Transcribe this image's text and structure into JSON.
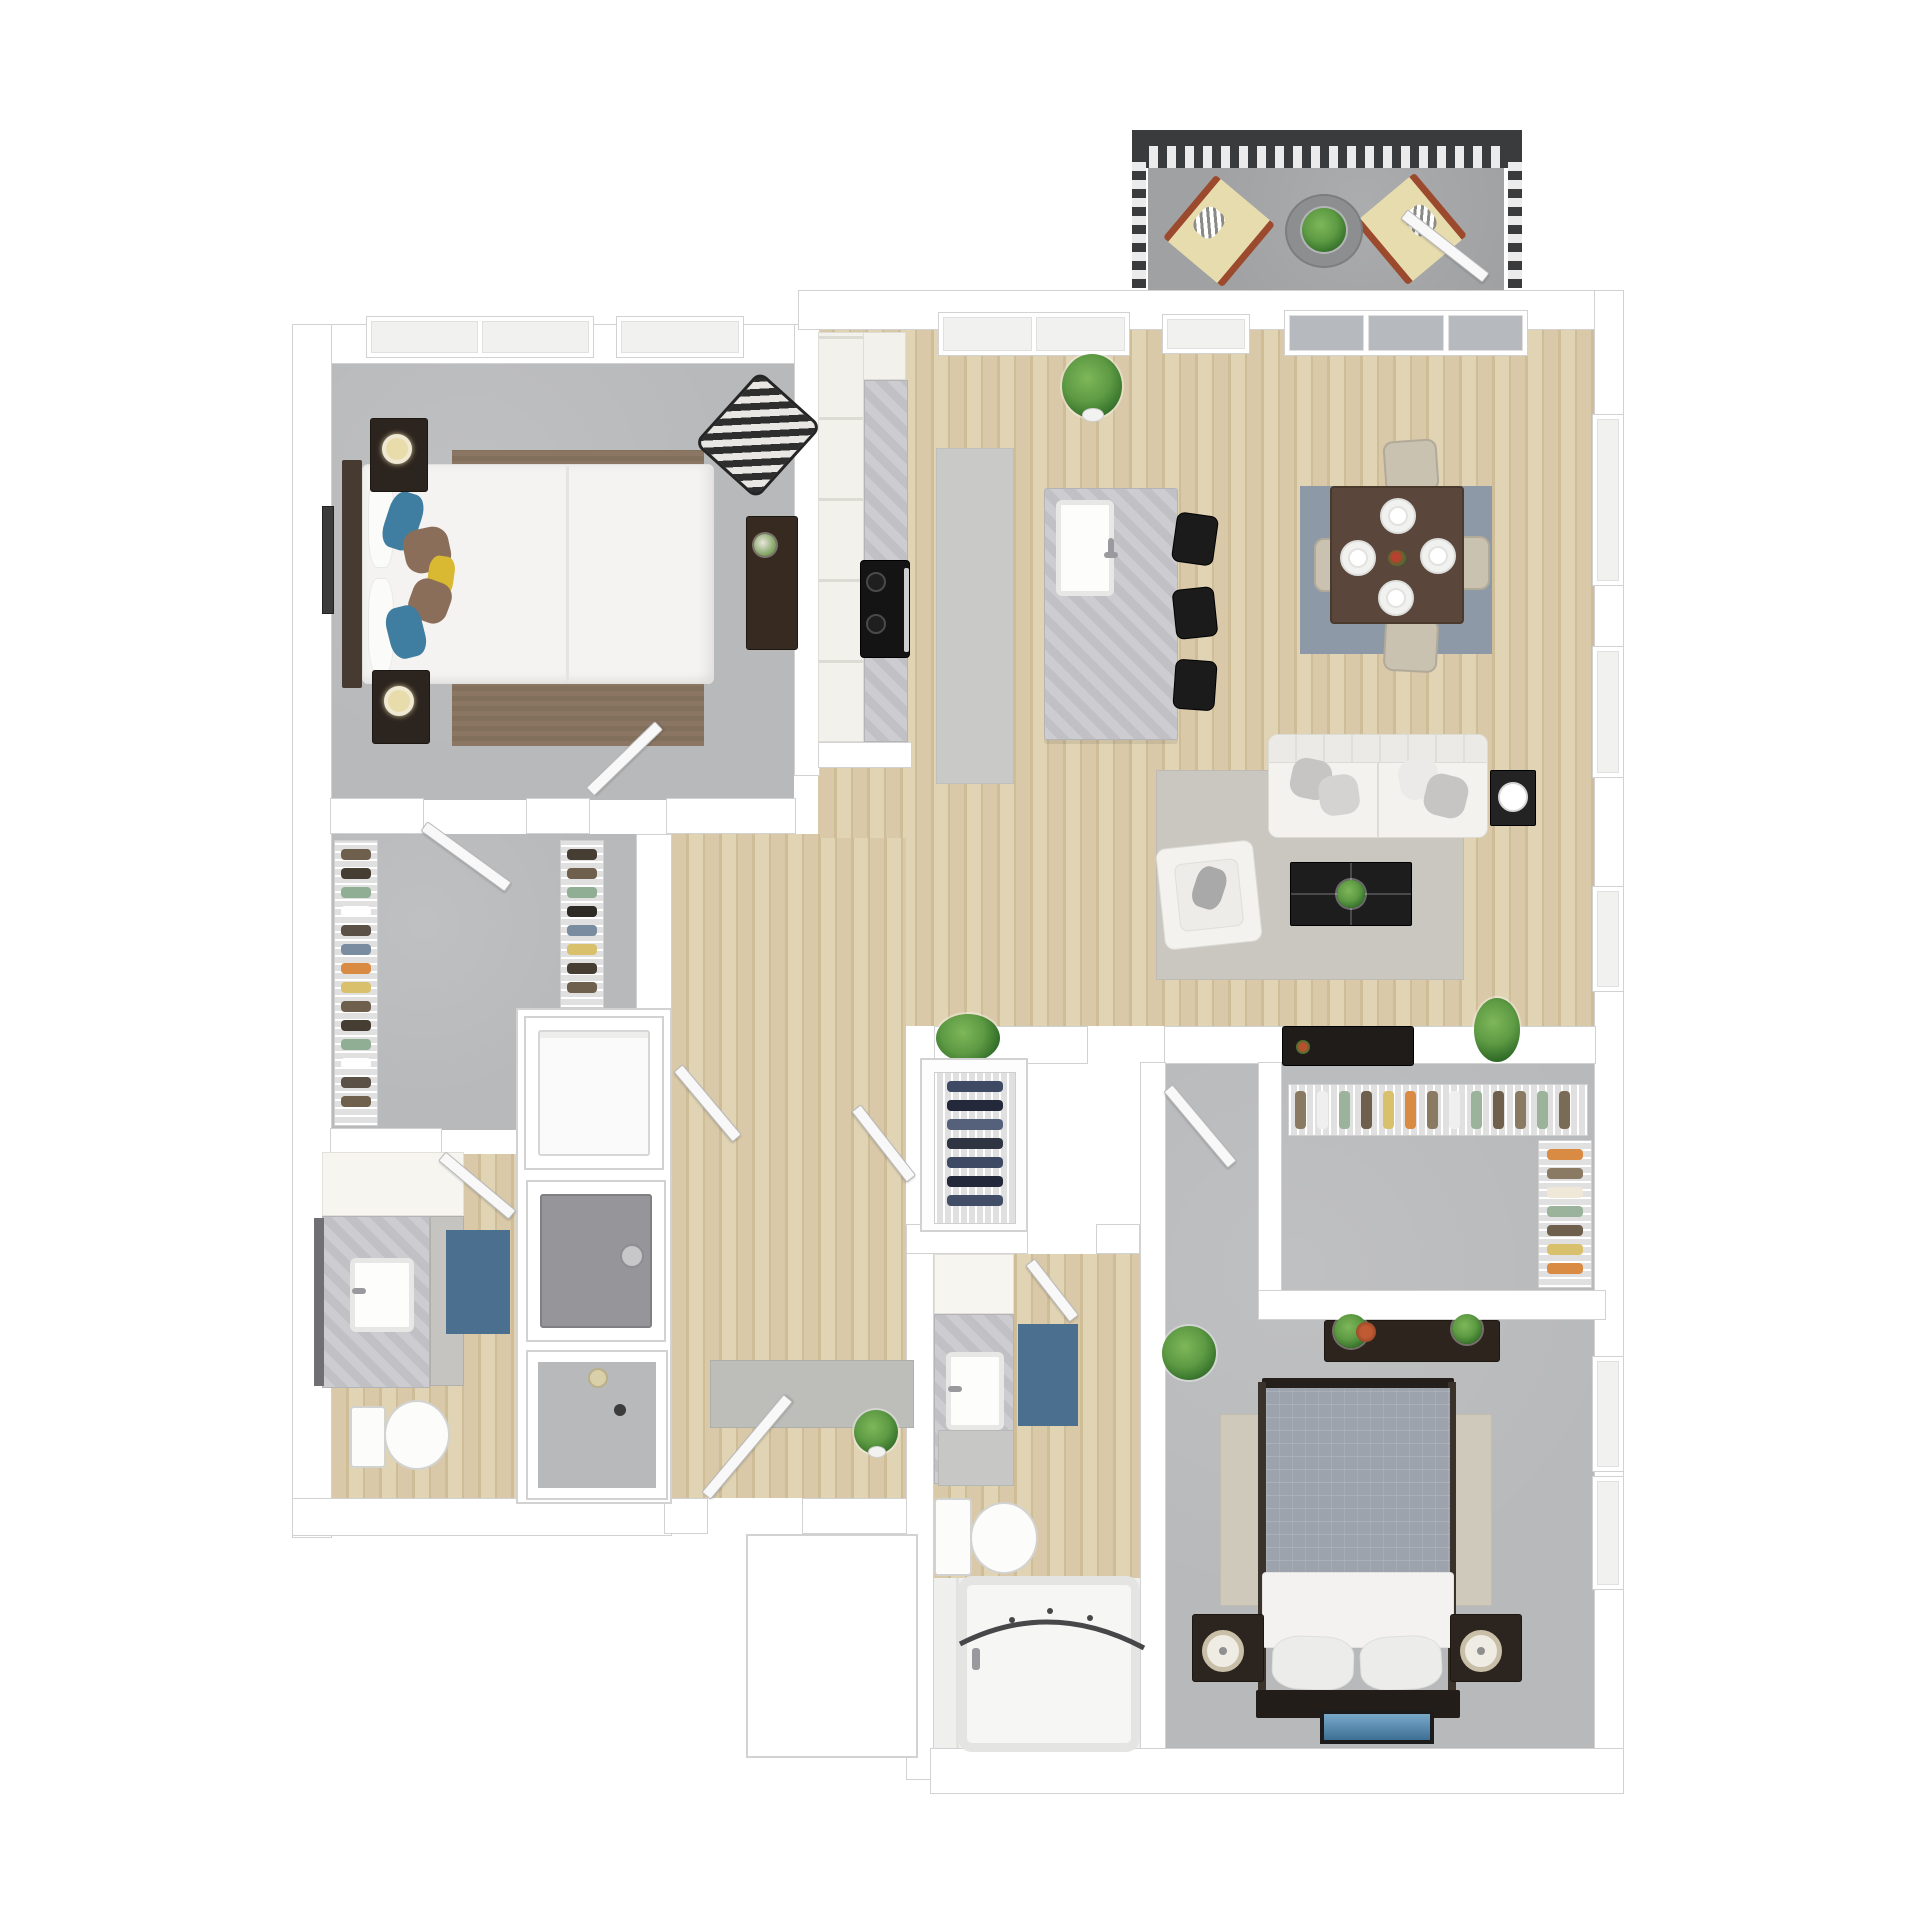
{
  "scene": {
    "kind": "3d-rendered-apartment-floor-plan",
    "rooms": [
      "balcony",
      "master-bedroom",
      "walk-in-closet",
      "bathroom-1",
      "laundry-column",
      "hallway",
      "kitchen",
      "dining-area",
      "living-room",
      "entry-closet",
      "bathroom-2",
      "bedroom-2",
      "closet-2",
      "entry"
    ],
    "furniture": [
      "lounge-chairs",
      "patio-table",
      "queen-bed",
      "nightstands",
      "desk",
      "chevron-armchair",
      "kitchen-island",
      "bar-stools",
      "cooktop",
      "dining-table",
      "dining-chairs",
      "sofa",
      "armchair",
      "coffee-table",
      "side-table",
      "tv-console",
      "washer",
      "dryer",
      "shower",
      "toilets",
      "vanities",
      "bathtub",
      "bed-2",
      "console-table",
      "plants"
    ]
  },
  "palette": {
    "wall": "#ffffff",
    "wall_line": "#d2d2d2",
    "carpet": "#b8b9bb",
    "wood1": "#d9c9a8",
    "wood2": "#cfbd98",
    "wood3": "#e1d4b5",
    "balcony": "#a0a1a3",
    "railing": "#3a3b3d",
    "marble1": "#cdccd0",
    "marble2": "#c1c0c4",
    "counter_white": "#f3f1ec",
    "runner": "#c9c9c7",
    "rug_brown1": "#8b7664",
    "rug_brown2": "#82705d",
    "rug_dining": "#8d99a7",
    "rug_living": "#c9c7bf",
    "rug_beige": "#cfc9bc",
    "rug_blue": "#4b6f8e",
    "mat_gray": "#c7c7c5",
    "sofa": "#f3f2ef",
    "sofa_line": "#dcdcd6",
    "pillow": "#c6c5c4",
    "dark_wood": "#2c241e",
    "black": "#1d1d1d",
    "bed_white": "#f4f3f1",
    "headboard": "#463a31",
    "blanket": "#9ca3ad",
    "table_brown": "#5a463a",
    "chair_beige": "#c9c2b1",
    "stool": "#1b1b1b",
    "leaf1": "#5d9a43",
    "leaf2": "#2f6b26",
    "appliance": "#96969a",
    "washer": "#fafafa",
    "glass": "#b6b9bd",
    "lamp_warm": "#e9dcab",
    "lounge_cushion": "#e7dcae",
    "lounge_frame": "#9c4a2e",
    "chevron_dark": "#2e2e2e",
    "chevron_light": "#e9e7e3",
    "pillow_teal": "#3f7ea0",
    "pillow_brown": "#8a6e5a",
    "pillow_yellow": "#d9b832",
    "photo_blue1": "#79a9c9",
    "photo_blue2": "#3d6f94",
    "shelf_cream": "#f7f5ef",
    "rack_bg": "#e0e0e0"
  },
  "clothing": {
    "walkin_left": [
      "#6f5f4d",
      "#463d33",
      "#8fae93",
      "#ffffff",
      "#5a5046",
      "#7a8da0",
      "#d98a43",
      "#d9c06c",
      "#6f5f4d",
      "#463d33",
      "#8fae93",
      "#ffffff",
      "#5a5046",
      "#6f5f4d"
    ],
    "walkin_right": [
      "#463d33",
      "#6f5f4d",
      "#8fae93",
      "#2e2a26",
      "#7a8da0",
      "#d9c06c",
      "#463d33",
      "#6f5f4d"
    ],
    "closet2_top": [
      "#8a7a64",
      "#efefef",
      "#9bb39a",
      "#6f5f4d",
      "#d9c06c",
      "#d98a43",
      "#8a7a64",
      "#efefef",
      "#9bb39a",
      "#6f5f4d",
      "#8a7a64",
      "#9bb39a",
      "#7a6b56"
    ],
    "closet2_right": [
      "#d98a43",
      "#8a7a64",
      "#efe8d8",
      "#9bb39a",
      "#6f5f4d",
      "#d9c06c",
      "#d98a43"
    ],
    "entry_shoes": [
      "#3e4a63",
      "#23283a",
      "#55607a",
      "#2e3442",
      "#3e4a63",
      "#23283a",
      "#424e68"
    ]
  },
  "dining": {
    "place_settings": 4
  }
}
